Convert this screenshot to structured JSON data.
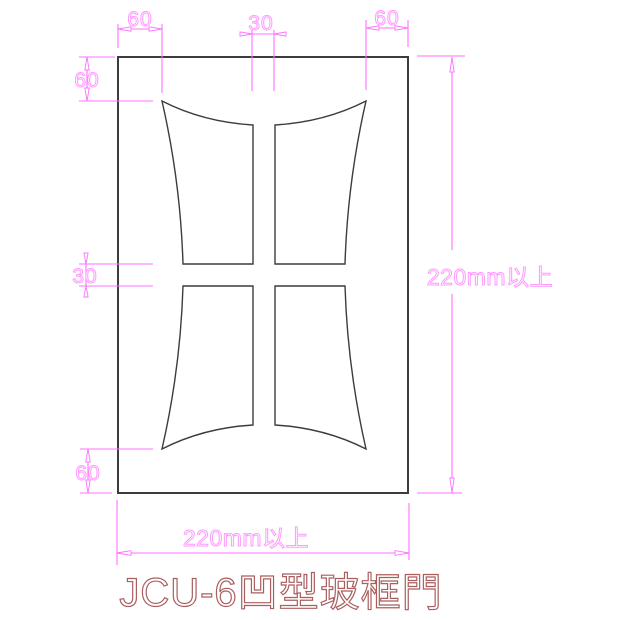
{
  "title": {
    "text": "JCU-6凹型玻框門"
  },
  "dimensions": {
    "top_left": "60",
    "top_center": "30",
    "top_right": "60",
    "left_top": "60",
    "left_middle": "30",
    "left_bottom": "60",
    "right_height": "220mm以上",
    "bottom_width": "220mm以上"
  },
  "colors": {
    "dimension_line": "#ff70ff",
    "dimension_text_outline": "#ff9aff",
    "drawing_line": "#3c3c3c",
    "title_outline": "#aa5f5f",
    "background": "#ffffff"
  }
}
